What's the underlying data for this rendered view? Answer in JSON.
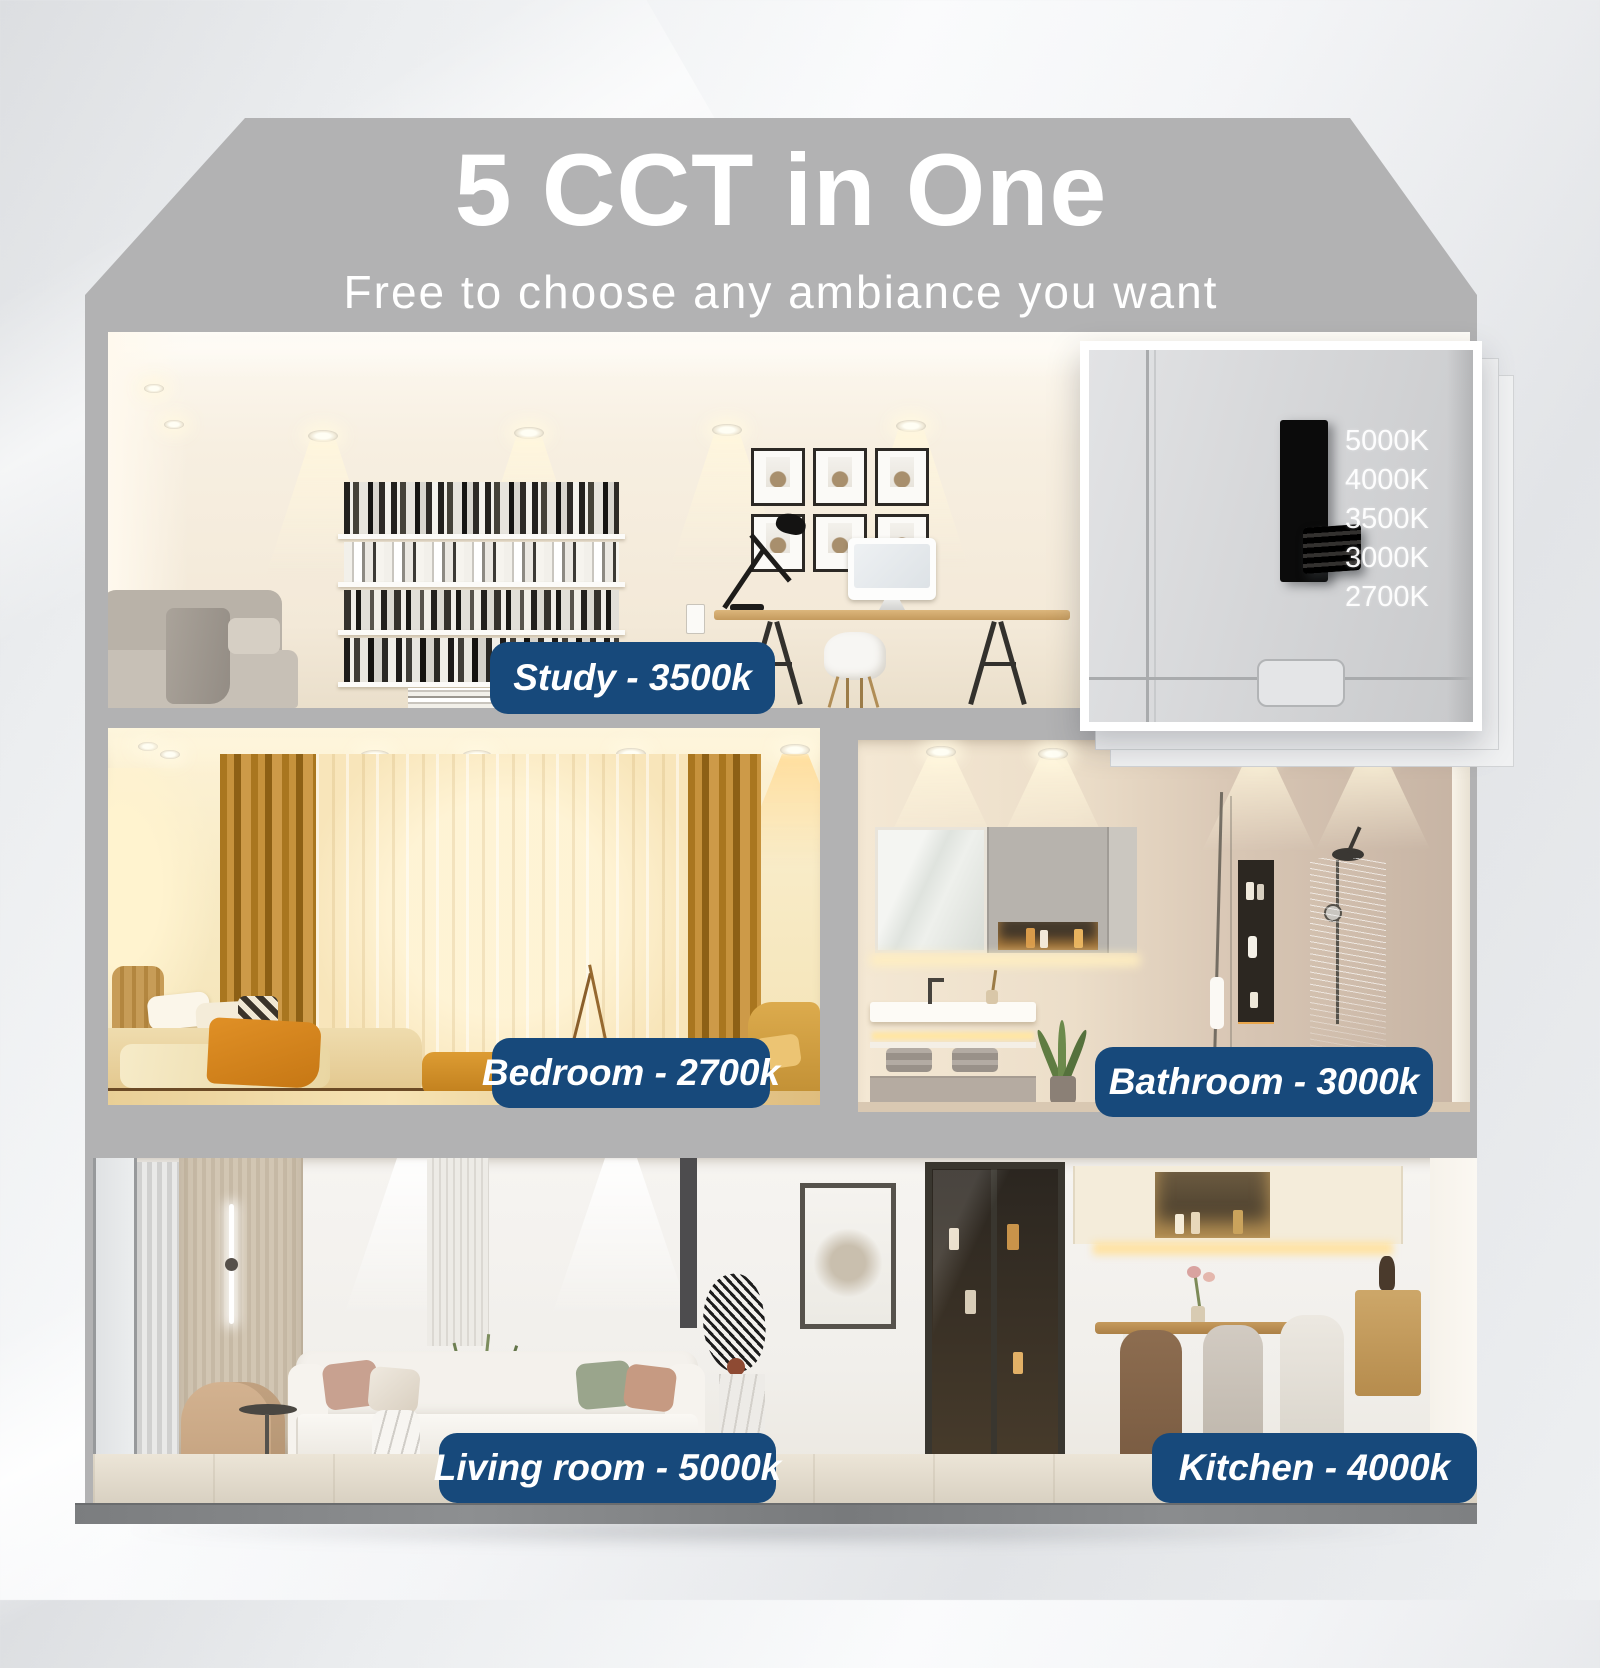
{
  "header": {
    "title": "5 CCT in One",
    "subtitle": "Free to choose any ambiance you want"
  },
  "cct_switch": {
    "options": [
      "5000K",
      "4000K",
      "3500K",
      "3000K",
      "2700K"
    ]
  },
  "rooms": {
    "study": {
      "label": "Study - 3500k"
    },
    "bedroom": {
      "label": "Bedroom - 2700k"
    },
    "bathroom": {
      "label": "Bathroom - 3000k"
    },
    "living_room": {
      "label": "Living room - 5000k"
    },
    "kitchen": {
      "label": "Kitchen - 4000k"
    }
  },
  "colors": {
    "badge_blue": "#17497B",
    "roof_gray": "#B2B2B3",
    "title_text": "#FFFFFF"
  }
}
